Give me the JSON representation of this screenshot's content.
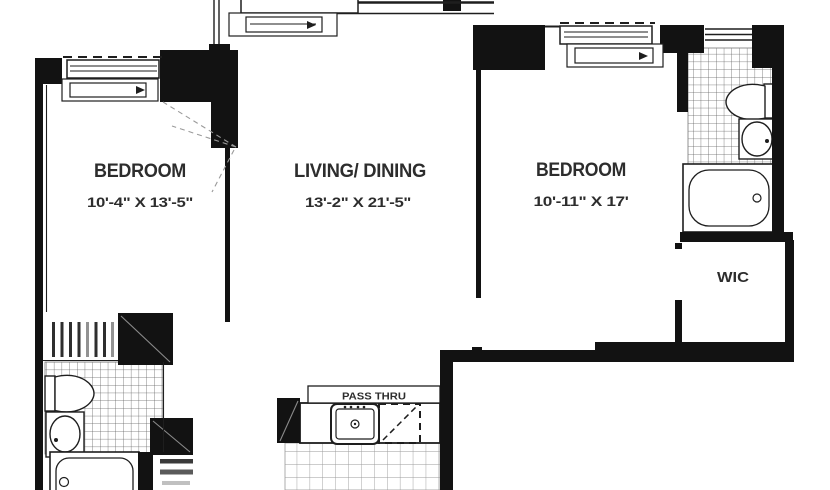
{
  "rooms": {
    "bedroom_left": {
      "label": "BEDROOM",
      "dims": "10'-4\" X 13'-5\""
    },
    "living_dining": {
      "label": "LIVING/ DINING",
      "dims": "13'-2\" X 21'-5\""
    },
    "bedroom_right": {
      "label": "BEDROOM",
      "dims": "10'-11\" X 17'"
    },
    "wic": {
      "label": "WIC"
    },
    "kitchen": {
      "pass_thru_label": "PASS THRU"
    }
  },
  "colors": {
    "wall": "#121212",
    "line": "#1e1e1e",
    "tile_line_bath": "#5f5f5f",
    "tile_line_kitchen": "#9a9a9a",
    "text": "#2d2d2d",
    "background": "#ffffff"
  }
}
